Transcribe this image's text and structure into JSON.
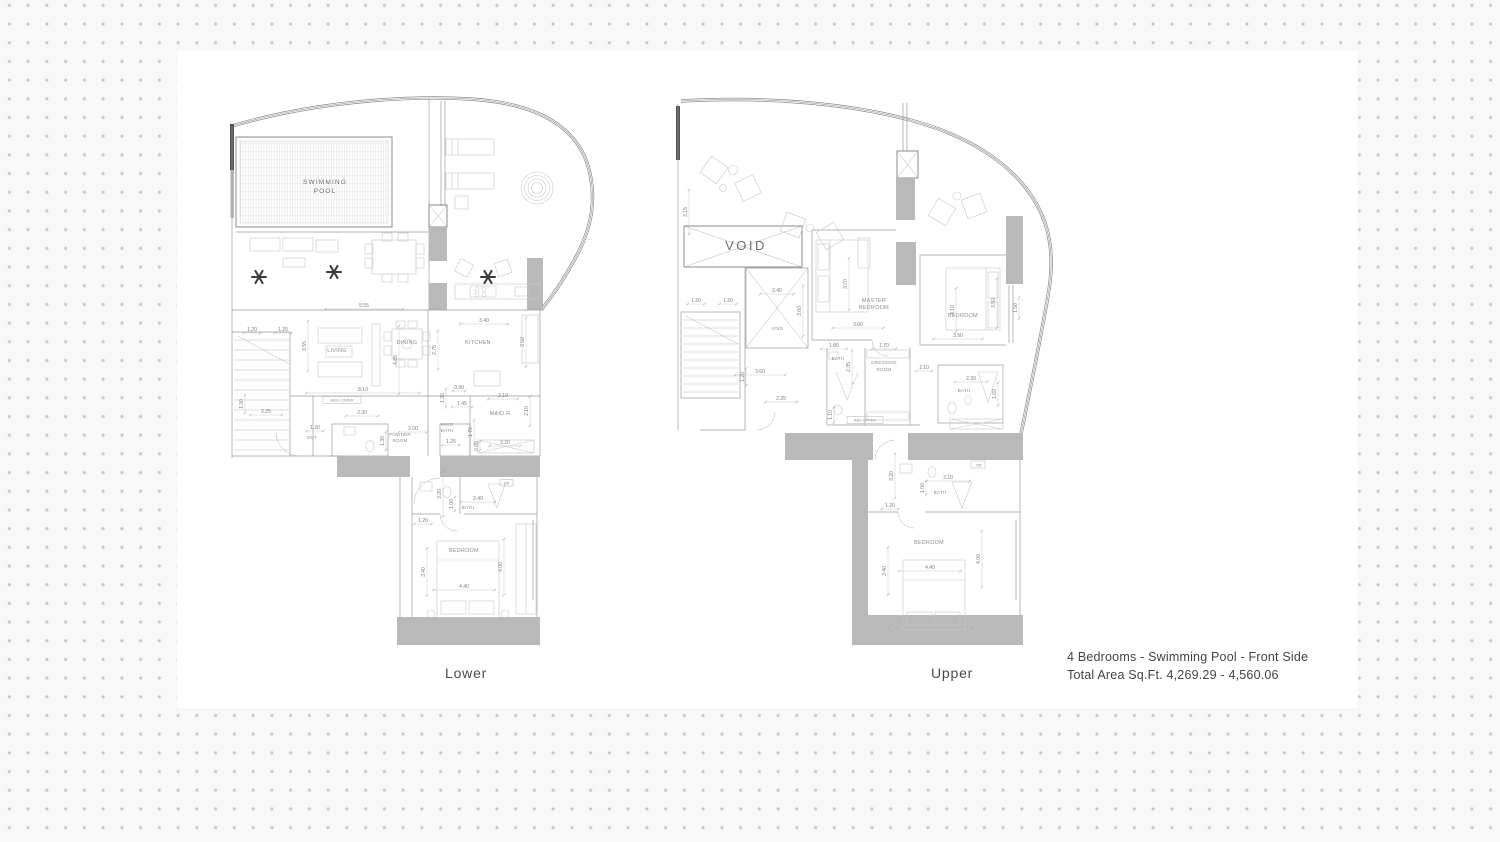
{
  "page": {
    "background_color": "#f8f8f8",
    "dot_color": "#c2c2c2",
    "panel_color": "#ffffff",
    "line_color": "#9a9a9a",
    "wall_fill_color": "#b9b9b9"
  },
  "footer": {
    "line1": "4 Bedrooms - Swimming Pool - Front Side",
    "line2": "Total Area Sq.Ft.  4,269.29 - 4,560.06"
  },
  "plans": {
    "lower": {
      "title": "Lower",
      "labels": [
        {
          "t": "SWIMMING",
          "x": 325,
          "y": 184,
          "c": "pool"
        },
        {
          "t": "POOL",
          "x": 325,
          "y": 193,
          "c": "pool"
        },
        {
          "t": "LIVING",
          "x": 337,
          "y": 352,
          "c": "room"
        },
        {
          "t": "DINING",
          "x": 407,
          "y": 344,
          "c": "room"
        },
        {
          "t": "KITCHEN",
          "x": 478,
          "y": 344,
          "c": "room"
        },
        {
          "t": "MAID.R",
          "x": 500,
          "y": 415,
          "c": "room"
        },
        {
          "t": "MAID",
          "x": 447,
          "y": 426,
          "c": "room2"
        },
        {
          "t": "BATH",
          "x": 447,
          "y": 432,
          "c": "room2"
        },
        {
          "t": "POWDER",
          "x": 400,
          "y": 436,
          "c": "room2"
        },
        {
          "t": "ROOM",
          "x": 400,
          "y": 442,
          "c": "room2"
        },
        {
          "t": "ENT",
          "x": 312,
          "y": 439,
          "c": "room2"
        },
        {
          "t": "BATH",
          "x": 468,
          "y": 509,
          "c": "room2"
        },
        {
          "t": "BEDROOM",
          "x": 464,
          "y": 552,
          "c": "room"
        },
        {
          "t": "DR",
          "x": 506.5,
          "y": 484.5,
          "c": "tiny"
        },
        {
          "t": "ABV LOWER",
          "x": 342,
          "y": 401.5,
          "c": "tiny"
        },
        {
          "t": "plant",
          "x": 259,
          "y": 277,
          "c": "plant"
        },
        {
          "t": "plant",
          "x": 334,
          "y": 272,
          "c": "plant"
        },
        {
          "t": "plant",
          "x": 488,
          "y": 277,
          "c": "plant"
        },
        {
          "t": "5.55",
          "x": 364,
          "y": 307,
          "c": "dim"
        },
        {
          "t": "3.40",
          "x": 484,
          "y": 322,
          "c": "dim"
        },
        {
          "t": "1.20",
          "x": 252,
          "y": 331,
          "c": "dim"
        },
        {
          "t": "1.20",
          "x": 283,
          "y": 331,
          "c": "dim"
        },
        {
          "t": "3.55",
          "x": 306,
          "y": 346,
          "r": -90,
          "c": "dim"
        },
        {
          "t": "2.75",
          "x": 436,
          "y": 350,
          "r": -90,
          "c": "dim"
        },
        {
          "t": "3.50",
          "x": 524,
          "y": 342,
          "r": -90,
          "c": "dim"
        },
        {
          "t": "4.85",
          "x": 397,
          "y": 360,
          "r": -90,
          "c": "dim"
        },
        {
          "t": "8.10",
          "x": 363,
          "y": 391,
          "c": "dim"
        },
        {
          "t": "1.30",
          "x": 243,
          "y": 404,
          "r": -90,
          "c": "dim"
        },
        {
          "t": "2.25",
          "x": 266,
          "y": 413,
          "c": "dim"
        },
        {
          "t": "2.30",
          "x": 362,
          "y": 414,
          "c": "dim"
        },
        {
          "t": "0.90",
          "x": 459,
          "y": 389,
          "c": "dim"
        },
        {
          "t": "1.30",
          "x": 444,
          "y": 398,
          "r": -90,
          "c": "dim"
        },
        {
          "t": "1.45",
          "x": 462,
          "y": 405,
          "c": "dim"
        },
        {
          "t": "2.10",
          "x": 503,
          "y": 397,
          "c": "dim"
        },
        {
          "t": "2.10",
          "x": 528,
          "y": 411,
          "r": -90,
          "c": "dim"
        },
        {
          "t": "2.00",
          "x": 413,
          "y": 430,
          "c": "dim"
        },
        {
          "t": "1.20",
          "x": 315,
          "y": 429,
          "c": "dim"
        },
        {
          "t": "1.30",
          "x": 384,
          "y": 441,
          "r": -90,
          "c": "dim"
        },
        {
          "t": "1.70",
          "x": 472,
          "y": 432,
          "r": -90,
          "c": "dim"
        },
        {
          "t": "1.25",
          "x": 451,
          "y": 443,
          "c": "dim"
        },
        {
          "t": "2.20",
          "x": 505,
          "y": 444,
          "c": "dim"
        },
        {
          "t": "0.60",
          "x": 478,
          "y": 446,
          "r": -90,
          "c": "dim"
        },
        {
          "t": "3.20",
          "x": 441,
          "y": 494,
          "r": -90,
          "c": "dim"
        },
        {
          "t": "2.40",
          "x": 478,
          "y": 500,
          "c": "dim"
        },
        {
          "t": "1.00",
          "x": 453,
          "y": 504,
          "r": -90,
          "c": "dim"
        },
        {
          "t": "1.20",
          "x": 423,
          "y": 522,
          "c": "dim"
        },
        {
          "t": "3.40",
          "x": 425,
          "y": 572,
          "r": -90,
          "c": "dim"
        },
        {
          "t": "4.00",
          "x": 502,
          "y": 567,
          "r": -90,
          "c": "dim"
        },
        {
          "t": "4.40",
          "x": 464,
          "y": 588,
          "c": "dim"
        }
      ]
    },
    "upper": {
      "title": "Upper",
      "labels": [
        {
          "t": "VOID",
          "x": 746,
          "y": 250,
          "c": "voidbig"
        },
        {
          "t": "VOID",
          "x": 777,
          "y": 330,
          "c": "room2"
        },
        {
          "t": "MASTER",
          "x": 874,
          "y": 302,
          "c": "room"
        },
        {
          "t": "BEDROOM",
          "x": 874,
          "y": 309,
          "c": "room"
        },
        {
          "t": "BEDROOM",
          "x": 963,
          "y": 317,
          "c": "room"
        },
        {
          "t": "BATH",
          "x": 838,
          "y": 360,
          "c": "room2"
        },
        {
          "t": "DRESSING",
          "x": 884,
          "y": 364,
          "c": "room2"
        },
        {
          "t": "ROOM",
          "x": 884,
          "y": 371,
          "c": "room2"
        },
        {
          "t": "BATH",
          "x": 964,
          "y": 392,
          "c": "room2"
        },
        {
          "t": "BATH",
          "x": 940,
          "y": 494,
          "c": "room2"
        },
        {
          "t": "BEDROOM",
          "x": 929,
          "y": 544,
          "c": "room"
        },
        {
          "t": "DR",
          "x": 979,
          "y": 466.5,
          "c": "tiny"
        },
        {
          "t": "ABV UPPER",
          "x": 865,
          "y": 421.3,
          "c": "tiny"
        },
        {
          "t": "3.15",
          "x": 687,
          "y": 212,
          "r": -90,
          "c": "dim"
        },
        {
          "t": "2.40",
          "x": 777,
          "y": 292,
          "c": "dim"
        },
        {
          "t": "3.60",
          "x": 801,
          "y": 311,
          "r": -90,
          "c": "dim"
        },
        {
          "t": "1.20",
          "x": 696,
          "y": 302,
          "c": "dim"
        },
        {
          "t": "1.20",
          "x": 728,
          "y": 302,
          "c": "dim"
        },
        {
          "t": "3.70",
          "x": 847,
          "y": 284,
          "r": -90,
          "c": "dim"
        },
        {
          "t": "3.60",
          "x": 858,
          "y": 326,
          "c": "dim"
        },
        {
          "t": "3.50",
          "x": 995,
          "y": 303,
          "r": -90,
          "c": "dim"
        },
        {
          "t": "3.10",
          "x": 954,
          "y": 310,
          "r": -90,
          "c": "dim"
        },
        {
          "t": "1.50",
          "x": 1017,
          "y": 308,
          "r": -90,
          "c": "dim"
        },
        {
          "t": "3.50",
          "x": 958,
          "y": 337,
          "c": "dim"
        },
        {
          "t": "1.80",
          "x": 834,
          "y": 347,
          "c": "dim"
        },
        {
          "t": "1.70",
          "x": 884,
          "y": 347,
          "c": "dim"
        },
        {
          "t": "2.35",
          "x": 850,
          "y": 367,
          "r": -90,
          "c": "dim"
        },
        {
          "t": "1.10",
          "x": 924,
          "y": 369,
          "c": "dim"
        },
        {
          "t": "3.60",
          "x": 760,
          "y": 373,
          "c": "dim"
        },
        {
          "t": "1.20",
          "x": 744,
          "y": 377,
          "r": -90,
          "c": "dim"
        },
        {
          "t": "2.25",
          "x": 781,
          "y": 400,
          "c": "dim"
        },
        {
          "t": "2.30",
          "x": 971,
          "y": 380,
          "c": "dim"
        },
        {
          "t": "1.60",
          "x": 996,
          "y": 394,
          "r": -90,
          "c": "dim"
        },
        {
          "t": "1.10",
          "x": 832,
          "y": 415,
          "r": -90,
          "c": "dim"
        },
        {
          "t": "3.20",
          "x": 893,
          "y": 476,
          "r": -90,
          "c": "dim"
        },
        {
          "t": "3.10",
          "x": 948,
          "y": 479,
          "c": "dim"
        },
        {
          "t": "1.00",
          "x": 924,
          "y": 488,
          "r": -90,
          "c": "dim"
        },
        {
          "t": "1.20",
          "x": 890,
          "y": 507,
          "c": "dim"
        },
        {
          "t": "3.40",
          "x": 886,
          "y": 571,
          "r": -90,
          "c": "dim"
        },
        {
          "t": "4.00",
          "x": 980,
          "y": 559,
          "r": -90,
          "c": "dim"
        },
        {
          "t": "4.40",
          "x": 930,
          "y": 569,
          "c": "dim"
        }
      ]
    }
  }
}
